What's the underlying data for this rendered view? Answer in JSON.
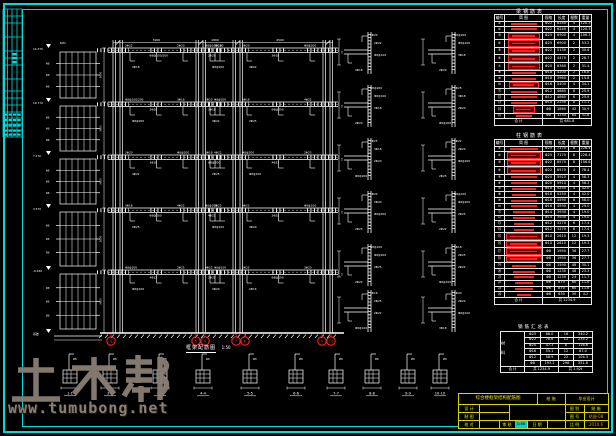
{
  "colors": {
    "background": "#000000",
    "line": "#ffffff",
    "frame": "#00dcdc",
    "accent_red": "#ff1e1e",
    "titleblock_yellow": "#e6e600",
    "watermark_gray": "#8a7f73"
  },
  "watermark": {
    "brand": "土木帮",
    "url": "www.tumubong.net"
  },
  "elevation": {
    "caption": "框架配筋图",
    "scale": "1:50",
    "column_tag": "KZ1",
    "bay_dims": [
      "3900",
      "1800",
      "4500"
    ],
    "story_dim": "3600",
    "levels": [
      "14.370",
      "10.770",
      "7.170",
      "3.570",
      "-0.030",
      "基础"
    ],
    "rebar_labels": [
      "2Φ22",
      "Φ8@100/200",
      "2Φ20",
      "3Φ18",
      "Φ8@200",
      "4Φ22",
      "2Φ25",
      "Φ8@100",
      "3Φ20",
      "2Φ16"
    ],
    "side_tag": "T",
    "ladder_tick_label": "Φ8"
  },
  "axes": {
    "bubbles": [
      {
        "x": 111,
        "label": "4"
      },
      {
        "x": 196,
        "label": "5"
      },
      {
        "x": 205,
        "label": "6"
      },
      {
        "x": 236,
        "label": "7"
      },
      {
        "x": 245,
        "label": "8"
      },
      {
        "x": 322,
        "label": "9"
      },
      {
        "x": 331,
        "label": "10"
      }
    ]
  },
  "node_labels": [
    "2Φ22",
    "Φ8@100",
    "3Φ18",
    "2Φ20",
    "Φ8@200",
    "2Φ25"
  ],
  "bottom_details": {
    "captions": [
      "1-1",
      "2-2",
      "3-3",
      "4-4",
      "5-5",
      "6-6",
      "7-7",
      "8-8",
      "9-9",
      "10-10"
    ],
    "tick_label": "Φ8"
  },
  "tables": [
    {
      "title": "梁钢筋表",
      "headers": [
        "编号",
        "简  图",
        "规格",
        "长度",
        "根数",
        "重量"
      ],
      "footer": [
        "合 计",
        "共 681.8"
      ],
      "rows": [
        {
          "no": "①",
          "dia": "Φ22",
          "len": "6240",
          "cnt": "4",
          "wt": "120.3",
          "w": 26,
          "box": false
        },
        {
          "no": "②",
          "dia": "Φ22",
          "len": "6240",
          "cnt": "4",
          "wt": "120.3",
          "w": 26,
          "box": false
        },
        {
          "no": "③",
          "dia": "Φ25",
          "len": "6900",
          "cnt": "4",
          "wt": "106.3",
          "w": 30,
          "box": true
        },
        {
          "no": "④",
          "dia": "Φ25",
          "len": "6900",
          "cnt": "2",
          "wt": "53.2",
          "w": 30,
          "box": true
        },
        {
          "no": "⑤",
          "dia": "Φ22",
          "len": "5130",
          "cnt": "2",
          "wt": "30.6",
          "w": 30,
          "box": true
        },
        {
          "no": "⑥",
          "dia": "Φ22",
          "len": "4470",
          "cnt": "2",
          "wt": "26.7",
          "w": 30,
          "box": true
        },
        {
          "no": "⑦",
          "dia": "Φ20",
          "len": "6360",
          "cnt": "2",
          "wt": "31.4",
          "w": 30,
          "box": true
        },
        {
          "no": "⑧",
          "dia": "Φ18",
          "len": "4200",
          "cnt": "2",
          "wt": "16.8",
          "w": 24,
          "box": false
        },
        {
          "no": "⑨",
          "dia": "Φ18",
          "len": "3960",
          "cnt": "2",
          "wt": "15.8",
          "w": 24,
          "box": false
        },
        {
          "no": "⑩",
          "dia": "Φ16",
          "len": "5400",
          "cnt": "4",
          "wt": "34.1",
          "w": 28,
          "box": true
        },
        {
          "no": "⑪",
          "dia": "Φ12",
          "len": "4860",
          "cnt": "6",
          "wt": "25.9",
          "w": 26,
          "box": false
        },
        {
          "no": "⑫",
          "dia": "Φ12",
          "len": "4860",
          "cnt": "6",
          "wt": "25.9",
          "w": 26,
          "box": false
        },
        {
          "no": "⑬",
          "dia": "Φ10",
          "len": "2250",
          "cnt": "8",
          "wt": "11.1",
          "w": 26,
          "box": false
        },
        {
          "no": "⑭",
          "dia": "Φ8",
          "len": "1860",
          "cnt": "42",
          "wt": "30.9",
          "w": 20,
          "box": true
        },
        {
          "no": "⑮",
          "dia": "Φ8",
          "len": "1250",
          "cnt": "64",
          "wt": "31.6",
          "w": 16,
          "box": false
        }
      ]
    },
    {
      "title": "柱钢筋表",
      "headers": [
        "编号",
        "简  图",
        "规格",
        "长度",
        "根数",
        "重量"
      ],
      "footer": [
        "合 计",
        "共 1234.9"
      ],
      "rows": [
        {
          "no": "①",
          "dia": "Φ25",
          "len": "7170",
          "cnt": "8",
          "wt": "226.4",
          "w": 28,
          "box": false
        },
        {
          "no": "②",
          "dia": "Φ25",
          "len": "7170",
          "cnt": "8",
          "wt": "226.4",
          "w": 32,
          "box": true
        },
        {
          "no": "③",
          "dia": "Φ22",
          "len": "6570",
          "cnt": "8",
          "wt": "156.8",
          "w": 32,
          "box": true
        },
        {
          "no": "④",
          "dia": "Φ22",
          "len": "6570",
          "cnt": "4",
          "wt": "78.4",
          "w": 32,
          "box": true
        },
        {
          "no": "⑤",
          "dia": "Φ20",
          "len": "5910",
          "cnt": "4",
          "wt": "58.3",
          "w": 26,
          "box": false
        },
        {
          "no": "⑥",
          "dia": "Φ20",
          "len": "5910",
          "cnt": "4",
          "wt": "58.3",
          "w": 26,
          "box": false
        },
        {
          "no": "⑦",
          "dia": "Φ18",
          "len": "5250",
          "cnt": "4",
          "wt": "42.0",
          "w": 24,
          "box": false
        },
        {
          "no": "⑧",
          "dia": "Φ18",
          "len": "5250",
          "cnt": "4",
          "wt": "42.0",
          "w": 24,
          "box": false
        },
        {
          "no": "⑨",
          "dia": "Φ16",
          "len": "4590",
          "cnt": "8",
          "wt": "58.0",
          "w": 26,
          "box": false
        },
        {
          "no": "⑩",
          "dia": "Φ16",
          "len": "4590",
          "cnt": "4",
          "wt": "29.0",
          "w": 26,
          "box": false
        },
        {
          "no": "⑪",
          "dia": "Φ14",
          "len": "3930",
          "cnt": "4",
          "wt": "19.0",
          "w": 22,
          "box": false
        },
        {
          "no": "⑫",
          "dia": "Φ14",
          "len": "3930",
          "cnt": "4",
          "wt": "19.0",
          "w": 22,
          "box": false
        },
        {
          "no": "⑬",
          "dia": "Φ12",
          "len": "3270",
          "cnt": "6",
          "wt": "17.4",
          "w": 20,
          "box": false
        },
        {
          "no": "⑭",
          "dia": "Φ12",
          "len": "3270",
          "cnt": "6",
          "wt": "17.4",
          "w": 20,
          "box": false
        },
        {
          "no": "⑮",
          "dia": "Φ10",
          "len": "2610",
          "cnt": "12",
          "wt": "19.3",
          "w": 34,
          "box": true
        },
        {
          "no": "⑯",
          "dia": "Φ10",
          "len": "2610",
          "cnt": "12",
          "wt": "19.3",
          "w": 34,
          "box": true
        },
        {
          "no": "⑰",
          "dia": "Φ8",
          "len": "1950",
          "cnt": "36",
          "wt": "27.7",
          "w": 34,
          "box": true
        },
        {
          "no": "⑱",
          "dia": "Φ8",
          "len": "1950",
          "cnt": "36",
          "wt": "27.7",
          "w": 34,
          "box": true
        },
        {
          "no": "⑲",
          "dia": "Φ8",
          "len": "1590",
          "cnt": "48",
          "wt": "30.1",
          "w": 24,
          "box": false
        },
        {
          "no": "⑳",
          "dia": "Φ8",
          "len": "1230",
          "cnt": "48",
          "wt": "23.3",
          "w": 22,
          "box": false
        },
        {
          "no": "㉑",
          "dia": "Φ8",
          "len": "1230",
          "cnt": "24",
          "wt": "11.7",
          "w": 20,
          "box": false
        },
        {
          "no": "㉒",
          "dia": "Φ6",
          "len": "870",
          "cnt": "60",
          "wt": "11.6",
          "w": 18,
          "box": false
        },
        {
          "no": "㉓",
          "dia": "Φ6",
          "len": "870",
          "cnt": "60",
          "wt": "11.6",
          "w": 18,
          "box": false
        },
        {
          "no": "㉔",
          "dia": "Φ6",
          "len": "630",
          "cnt": "30",
          "wt": "4.2",
          "w": 14,
          "box": false
        }
      ]
    }
  ],
  "summary": {
    "title": "钢筋汇总表",
    "side": "材 料",
    "rows": [
      [
        "Φ25",
        "86.0",
        "16",
        "340.2"
      ],
      [
        "Φ22",
        "78.8",
        "12",
        "235.2"
      ],
      [
        "Φ20",
        "47.3",
        "8",
        "116.6"
      ],
      [
        "Φ16",
        "55.1",
        "12",
        "87.0"
      ],
      [
        "Φ12",
        "58.9",
        "22",
        "104.3"
      ],
      [
        "Φ8",
        "193.2",
        "298",
        "351.6"
      ]
    ],
    "footer": [
      "合 计",
      "共 1234.9",
      "共 1.92t"
    ]
  },
  "titleblock": {
    "title": "综合楼框架结构配筋图",
    "doc_type": "结 施",
    "project": "毕业设计",
    "f_design": "设 计",
    "f_draw": "制 图",
    "f_review": "校 对",
    "f_check": "审 核",
    "f_sheet_type": "图 别",
    "f_sheet_type_v": "结 施",
    "f_sheet_no": "图 号",
    "f_sheet_no_v": "结施-08",
    "f_date": "日 期",
    "f_date_v": "2010.6",
    "f_scale": "比 例",
    "scale_v": "1:50",
    "f_pages": "共  页",
    "f_page": "第  页"
  }
}
